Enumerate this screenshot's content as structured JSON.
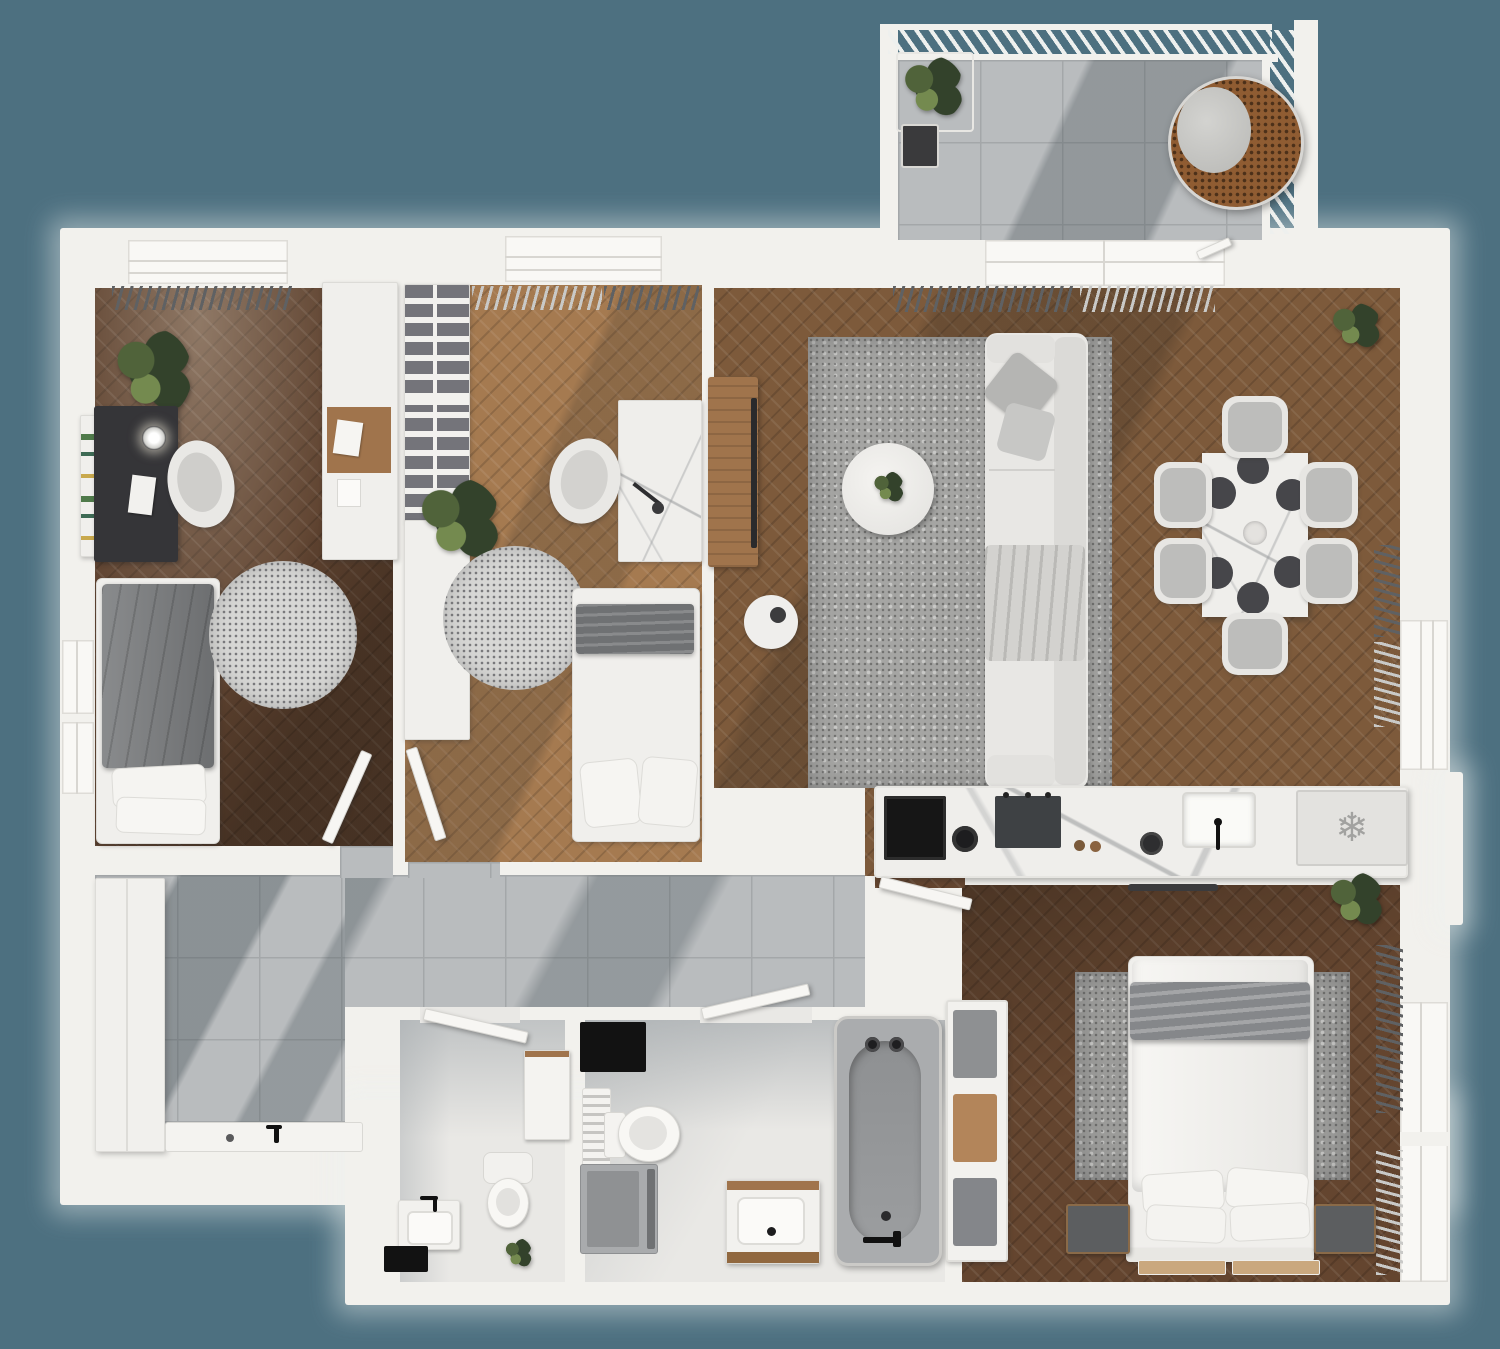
{
  "app": {
    "title": "3D Apartment Floor Plan",
    "view": "top-down architectural render"
  },
  "palette": {
    "bg": "#4d7080",
    "wall": "#f2f1ed",
    "wallEdge": "#d9d8d4",
    "woodOffice": "#5f4330",
    "woodKids": "#a57a50",
    "woodLiving": "#7d5a3b",
    "woodBedroom": "#64452f",
    "tile": "#b9bcbe",
    "tileLine": "#a4a7a9",
    "bathFloor": "#e9e8e5",
    "marbleWall": "#caccce",
    "rugLight": "#d7d7d5",
    "rugDot": "#77777a",
    "rugLiving": "#a5a5a3",
    "sofa": "#e8e7e4",
    "grayFurniture": "#797b7d",
    "charcoal": "#353538",
    "black": "#141414",
    "woodFurniture": "#a0744c",
    "greenDark": "#33422b",
    "greenMid": "#50633a",
    "greenLight": "#748a4f",
    "wicker": "#8f5c32",
    "curtainDark": "#5f6163",
    "curtainLight": "#c9c9c7"
  },
  "rooms": [
    {
      "id": "office",
      "name": "Home Office",
      "floor": "dark herringbone parquet",
      "furniture": [
        "desk",
        "desk-chair",
        "desk-lamp",
        "daybed",
        "round-rug",
        "plant",
        "bookshelf",
        "wall-cabinet"
      ]
    },
    {
      "id": "kids-bedroom",
      "name": "Kids Bedroom",
      "floor": "light herringbone parquet",
      "furniture": [
        "wardrobe-shelves",
        "single-bed",
        "desk",
        "desk-chair",
        "round-rug",
        "plant"
      ]
    },
    {
      "id": "living-room",
      "name": "Living / Dining Room",
      "floor": "herringbone parquet",
      "furniture": [
        "sofa",
        "coffee-table",
        "area-rug",
        "tv-console",
        "side-table",
        "dining-table",
        "dining-chairs x6",
        "plant"
      ]
    },
    {
      "id": "kitchen",
      "name": "Kitchen",
      "floor": "parquet",
      "furniture": [
        "counter",
        "oven",
        "cooktop",
        "pots",
        "sink",
        "fridge"
      ]
    },
    {
      "id": "master-bedroom",
      "name": "Master Bedroom",
      "floor": "dark herringbone parquet",
      "furniture": [
        "double-bed",
        "nightstand x2",
        "area-rug",
        "plant",
        "bedside-mats"
      ]
    },
    {
      "id": "bathroom",
      "name": "Bathroom",
      "floor": "stone tile",
      "furniture": [
        "bathtub",
        "vanity-sink",
        "toilet",
        "washing-machine",
        "towel-ladder",
        "bath-mat",
        "towel-shelf"
      ]
    },
    {
      "id": "wc",
      "name": "WC",
      "floor": "stone tile",
      "furniture": [
        "toilet",
        "hand-basin",
        "cabinet",
        "plant",
        "bath-mat"
      ]
    },
    {
      "id": "hallway",
      "name": "Hallway / Entry",
      "floor": "gray ceramic tile",
      "furniture": [
        "tall-cabinet",
        "shower-tray"
      ]
    },
    {
      "id": "balcony",
      "name": "Balcony",
      "floor": "gray ceramic tile",
      "furniture": [
        "hanging-egg-chair",
        "planter-stand",
        "potted-plant"
      ]
    }
  ],
  "fixtures": {
    "windows": 7,
    "doors": 5,
    "railing": "hatched balcony railing"
  },
  "icons": {
    "fridge": "❄"
  }
}
